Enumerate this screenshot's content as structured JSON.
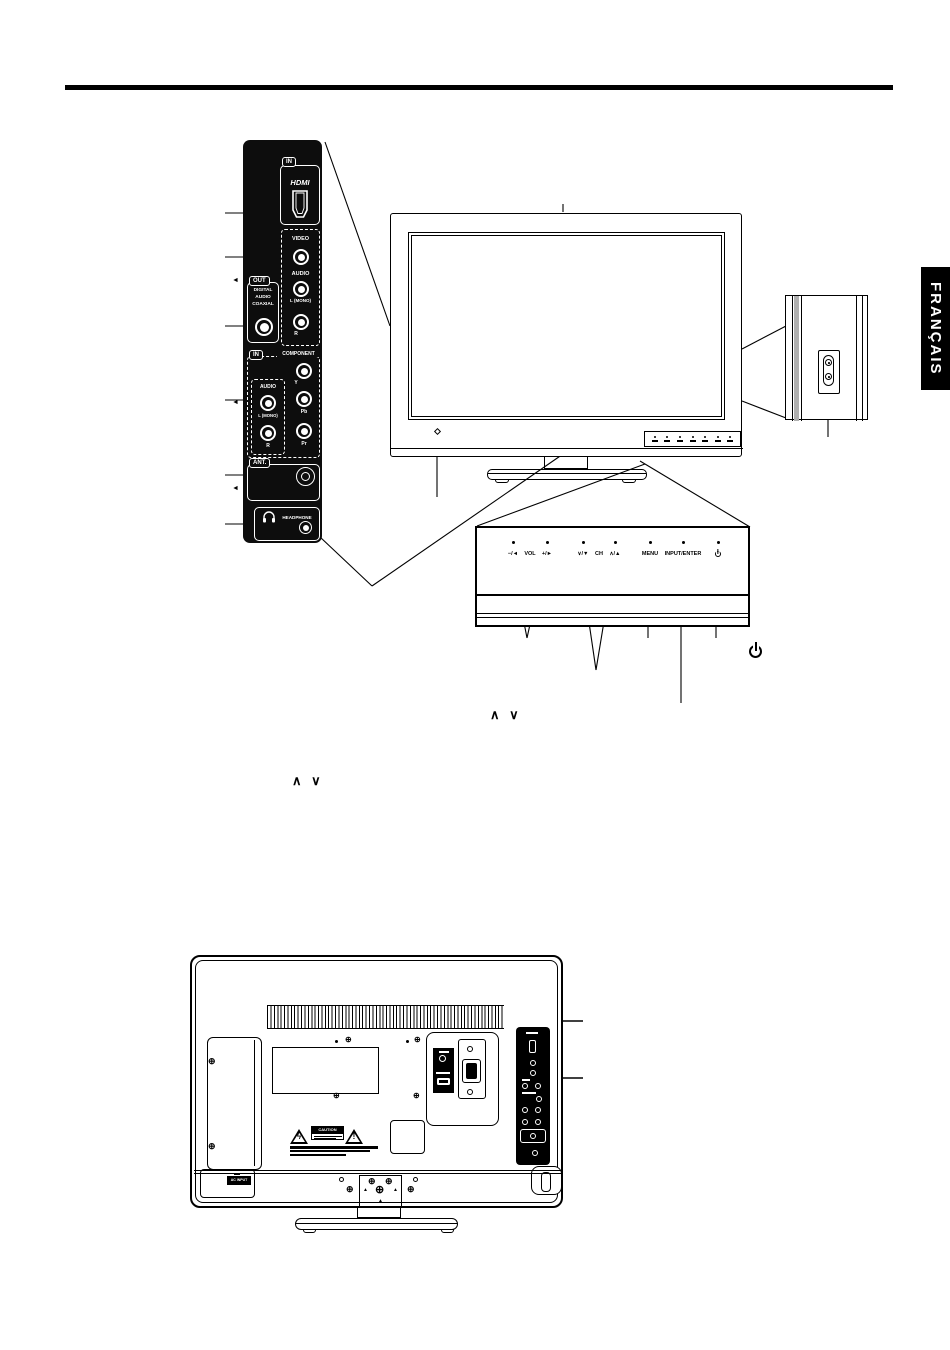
{
  "language_tab": "FRANÇAIS",
  "side_panel": {
    "hdmi_in_tab": "IN",
    "hdmi_logo": "HDMI",
    "video_label": "VIDEO",
    "audio_label": "AUDIO",
    "l_mono_label": "L (MONO)",
    "r_label": "R",
    "out_tab": "OUT",
    "digital_line1": "DIGITAL",
    "digital_line2": "AUDIO",
    "digital_line3": "COAXIAL",
    "component_in_tab": "IN",
    "component_label": "COMPONENT",
    "comp_audio_label": "AUDIO",
    "comp_l_mono_label": "L (MONO)",
    "comp_r_label": "R",
    "y_label": "Y",
    "pb_label": "Pb",
    "pr_label": "Pr",
    "ant_label": "ANT.",
    "headphone_label": "HEADPHONE"
  },
  "control_panel": {
    "vol_minus": "−/◄",
    "vol_label": "VOL",
    "vol_plus": "+/►",
    "ch_down": "∨/▼",
    "ch_label": "CH",
    "ch_up": "∧/▲",
    "menu_label": "MENU",
    "input_enter_label": "INPUT/ENTER"
  },
  "annotations": {
    "channel_arrows_1": "∧ ∨",
    "channel_arrows_2": "∧ ∨"
  },
  "back_panel": {
    "ac_input_label": "AC INPUT",
    "caution_label": "CAUTION"
  },
  "icons": {
    "power_icon": "power-circle-with-bar",
    "headphone_icon": "headphones",
    "hdmi_connector_icon": "hdmi-plug",
    "screw_glyph": "⊕",
    "triangle_glyph": "▲",
    "arrow_left_glyph": "◄",
    "arrow_right_glyph": "►",
    "lightning_glyph": "ϟ",
    "exclamation_glyph": "!"
  },
  "colors": {
    "panel_bg": "#0d0d0d",
    "line": "#000000"
  }
}
